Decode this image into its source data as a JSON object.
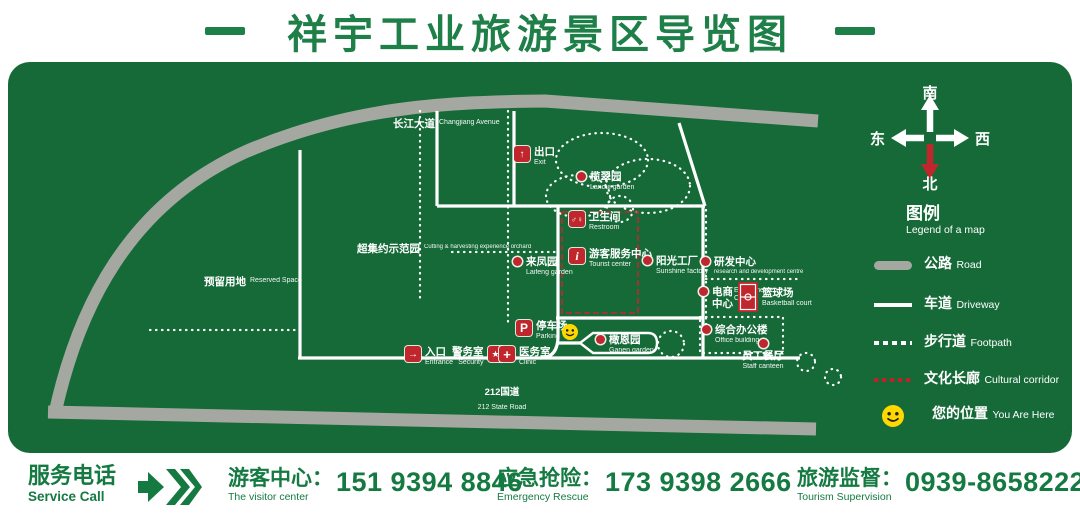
{
  "header": {
    "title": "祥宇工业旅游景区导览图"
  },
  "map": {
    "changjiang": {
      "zh": "长江大道",
      "en": "Changjiang Avenue"
    },
    "road212": {
      "zh": "212国道",
      "en": "212 State Road"
    },
    "pois": {
      "exit": {
        "zh": "出口",
        "en": "Exit"
      },
      "lancui": {
        "zh": "榄翠园",
        "en": "Lancui garden"
      },
      "restroom": {
        "zh": "卫生间",
        "en": "Restroom"
      },
      "tourist": {
        "zh": "游客服务中心",
        "en": "Tourist center"
      },
      "sunshine": {
        "zh": "阳光工厂",
        "en": "Sunshine factory"
      },
      "laifeng": {
        "zh": "来凤园",
        "en": "Laifeng garden"
      },
      "demo_orchard": {
        "zh": "超集约示范园",
        "en": "Cutting & harvesting experience orchard"
      },
      "reserved": {
        "zh": "预留用地",
        "en": "Reserved Space"
      },
      "rd": {
        "zh": "研发中心",
        "en": "research and development centre"
      },
      "ecommerce": {
        "zh1": "电商",
        "zh2": "中心",
        "en": "E-commerce Center"
      },
      "basketball": {
        "zh": "篮球场",
        "en": "Basketball court"
      },
      "office": {
        "zh": "综合办公楼",
        "en": "Office building"
      },
      "canteen": {
        "zh": "员工餐厅",
        "en": "Staff canteen"
      },
      "parking": {
        "zh": "停车场",
        "en": "Parking"
      },
      "entrance": {
        "zh": "入口",
        "en": "Entrance"
      },
      "security": {
        "zh": "警务室",
        "en": "Security"
      },
      "clinic": {
        "zh": "医务室",
        "en": "Clinic"
      },
      "ganen": {
        "zh": "橄恩园",
        "en": "Ganen garden"
      }
    }
  },
  "icons": {
    "exit": "↑",
    "entrance": "→",
    "restroom": "♂♀",
    "tourist": "i",
    "parking": "P",
    "security": "★",
    "clinic": "+"
  },
  "compass": {
    "south": "南",
    "north": "北",
    "east": "东",
    "west": "西"
  },
  "legend": {
    "title_zh": "图例",
    "title_en": "Legend of a map",
    "items": [
      {
        "zh": "公路",
        "en": "Road",
        "type": "road"
      },
      {
        "zh": "车道",
        "en": "Driveway",
        "type": "driveway"
      },
      {
        "zh": "步行道",
        "en": "Footpath",
        "type": "footpath"
      },
      {
        "zh": "文化长廊",
        "en": "Cultural corridor",
        "type": "cultural-corridor"
      },
      {
        "zh": "您的位置",
        "en": "You Are Here",
        "type": "you-are-here"
      }
    ]
  },
  "footer": {
    "service": {
      "zh": "服务电话",
      "en": "Service Call"
    },
    "contacts": [
      {
        "zh": "游客中心：",
        "en": "The visitor center",
        "phone": "151 9394 8846"
      },
      {
        "zh": "应急抢险：",
        "en": "Emergency Rescue",
        "phone": "173 9398 2666"
      },
      {
        "zh": "旅游监督：",
        "en": "Tourism Supervision",
        "phone": "0939-8658222"
      }
    ]
  },
  "colors": {
    "panel_green": "#166a38",
    "title_green": "#1e7f48",
    "marker_red": "#c0272d",
    "road_gray": "#a4a8a1",
    "smiley_yellow": "#ffd800"
  }
}
